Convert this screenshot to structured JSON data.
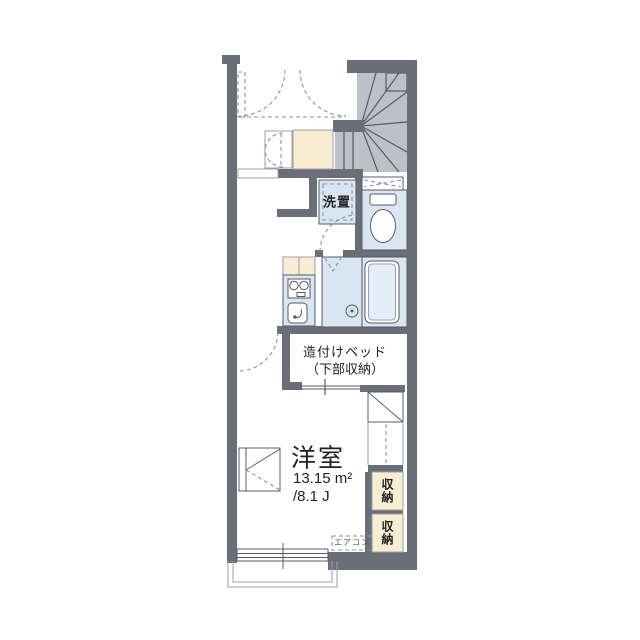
{
  "plan": {
    "labels": {
      "laundry": "洗置",
      "bed_line1": "造付けベッド",
      "bed_line2": "（下部収納）",
      "room_name": "洋室",
      "room_area": "13.15 m²",
      "room_tatami": "/8.1 J",
      "storage_upper": "収納",
      "storage_lower": "収納",
      "aircon": "エアコン"
    },
    "colors": {
      "wall": "#6a6e78",
      "stair": "#bcc0c7",
      "water": "#d9e6f2",
      "cream": "#f8ecd3",
      "line": "#565b64",
      "dash": "#8f939c",
      "light": "#9aa0a8",
      "ink": "#222222",
      "bg": "#ffffff"
    },
    "symbols": [
      "staircase",
      "entry-door-swing",
      "shoe-cabinet",
      "hall-closet",
      "washer-space",
      "toilet",
      "overhead-shelf",
      "kitchen-stove",
      "kitchen-sink",
      "unit-bath",
      "bathtub",
      "built-in-bed",
      "under-stair-closet",
      "storage-box-upper",
      "storage-box-lower",
      "air-conditioner",
      "desk-counter",
      "window",
      "balcony"
    ]
  }
}
